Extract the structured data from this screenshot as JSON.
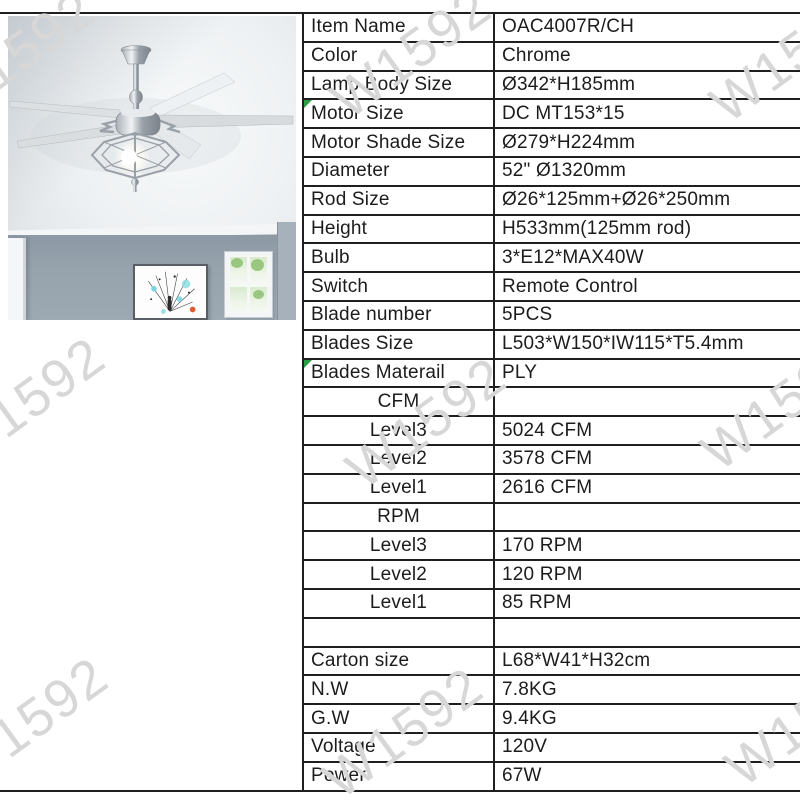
{
  "watermark": {
    "text": "W1592"
  },
  "table": {
    "rows": [
      {
        "label": "Item Name",
        "value": "OAC4007R/CH"
      },
      {
        "label": "Color",
        "value": "Chrome"
      },
      {
        "label": "Lamp Body Size",
        "value": "Ø342*H185mm"
      },
      {
        "label": "Motor Size",
        "value": "DC MT153*15"
      },
      {
        "label": "Motor Shade Size",
        "value": "Ø279*H224mm"
      },
      {
        "label": "Diameter",
        "value": "52\" Ø1320mm"
      },
      {
        "label": "Rod Size",
        "value": "Ø26*125mm+Ø26*250mm"
      },
      {
        "label": "Height",
        "value": "H533mm(125mm rod)"
      },
      {
        "label": "Bulb",
        "value": "3*E12*MAX40W"
      },
      {
        "label": "Switch",
        "value": "Remote Control"
      },
      {
        "label": "Blade number",
        "value": "5PCS"
      },
      {
        "label": "Blades Size",
        "value": "L503*W150*IW115*T5.4mm"
      },
      {
        "label": "Blades Materail",
        "value": "PLY"
      },
      {
        "label": "CFM",
        "value": ""
      },
      {
        "label": "Level3",
        "value": "5024 CFM"
      },
      {
        "label": "Level2",
        "value": "3578 CFM"
      },
      {
        "label": "Level1",
        "value": "2616 CFM"
      },
      {
        "label": "RPM",
        "value": ""
      },
      {
        "label": "Level3",
        "value": "170 RPM"
      },
      {
        "label": "Level2",
        "value": "120 RPM"
      },
      {
        "label": "Level1",
        "value": "85 RPM"
      },
      {
        "label": "",
        "value": ""
      },
      {
        "label": "Carton size",
        "value": "L68*W41*H32cm"
      },
      {
        "label": "N.W",
        "value": "7.8KG"
      },
      {
        "label": "G.W",
        "value": "9.4KG"
      },
      {
        "label": "Voltage",
        "value": "120V"
      },
      {
        "label": "Power",
        "value": "67W"
      }
    ]
  }
}
